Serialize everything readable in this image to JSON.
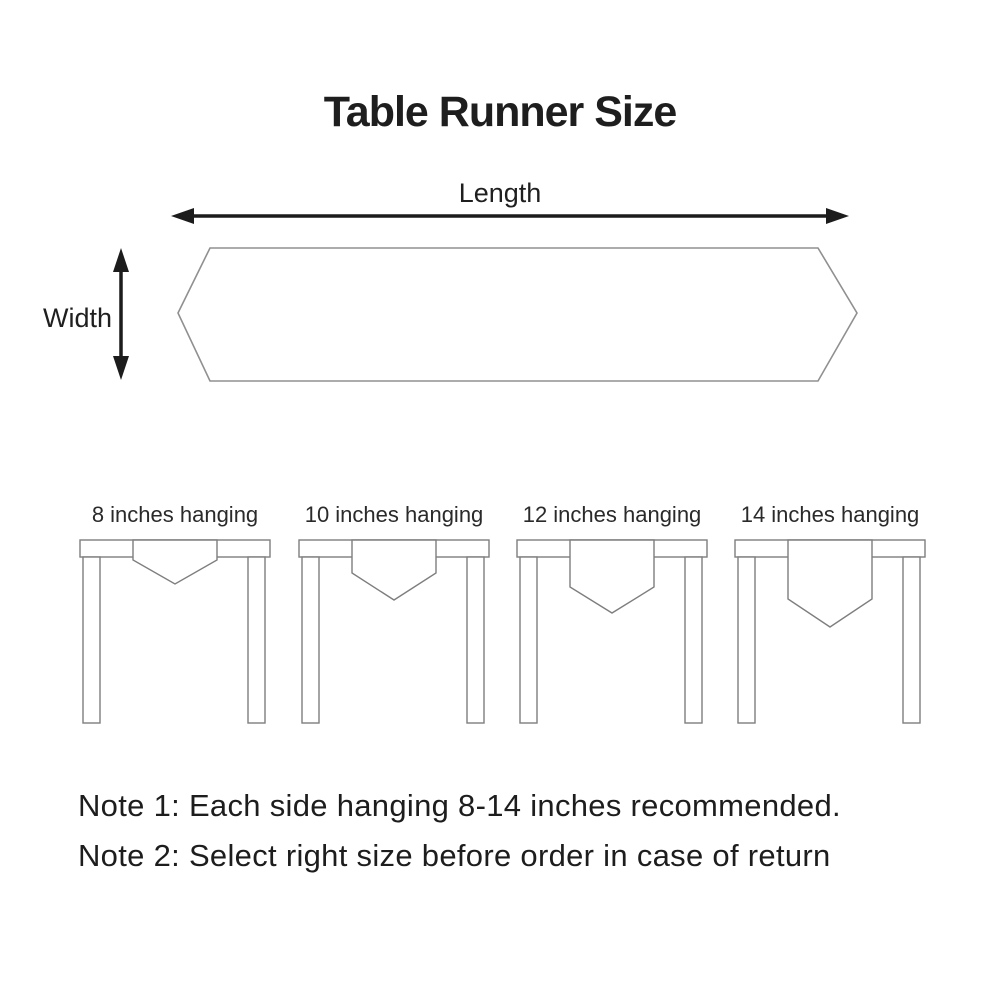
{
  "header": {
    "title": "Table Runner Size"
  },
  "top_diagram": {
    "length_label": "Length",
    "width_label": "Width",
    "shape": "elongated-hexagon-runner"
  },
  "tables": [
    {
      "label": "8 inches hanging",
      "hang_inches": 8
    },
    {
      "label": "10 inches hanging",
      "hang_inches": 10
    },
    {
      "label": "12 inches hanging",
      "hang_inches": 12
    },
    {
      "label": "14 inches hanging",
      "hang_inches": 14
    }
  ],
  "notes": [
    {
      "text": "Note 1: Each side hanging 8-14 inches recommended."
    },
    {
      "text": "Note 2: Select right size before order in case of return"
    }
  ],
  "colors": {
    "text": "#1e1e1e",
    "arrow": "#1c1c1c",
    "runner_outline": "#909090",
    "table_outline": "#7e7e7e",
    "background": "#ffffff"
  }
}
